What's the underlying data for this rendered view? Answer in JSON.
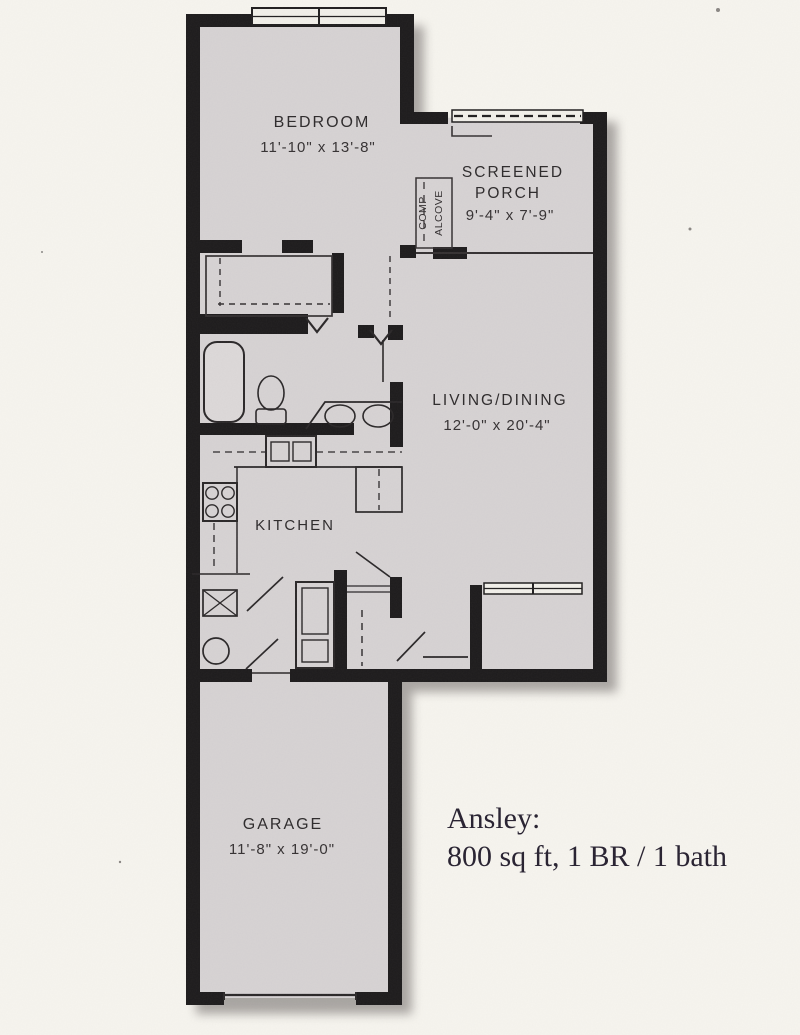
{
  "document": {
    "type": "scanned floor plan",
    "colors": {
      "page": "#f6f4ee",
      "floor": "#d6d2d3",
      "wall": "#1d1b1c",
      "shadow": "#6a6563",
      "ink": "#2d2a2b"
    }
  },
  "rooms": {
    "bedroom": {
      "name": "BEDROOM",
      "dims": "11'-10\" x 13'-8\""
    },
    "screened_porch": {
      "name_line1": "SCREENED",
      "name_line2": "PORCH",
      "dims": "9'-4\" x 7'-9\""
    },
    "comp_alcove": {
      "line1": "COMP",
      "line2": "ALCOVE"
    },
    "living_dining": {
      "name": "LIVING/DINING",
      "dims": "12'-0\" x 20'-4\""
    },
    "kitchen": {
      "name": "KITCHEN"
    },
    "garage": {
      "name": "GARAGE",
      "dims": "11'-8\" x 19'-0\""
    }
  },
  "caption": {
    "line1": "Ansley:",
    "line2": "800 sq ft, 1 BR / 1 bath"
  }
}
